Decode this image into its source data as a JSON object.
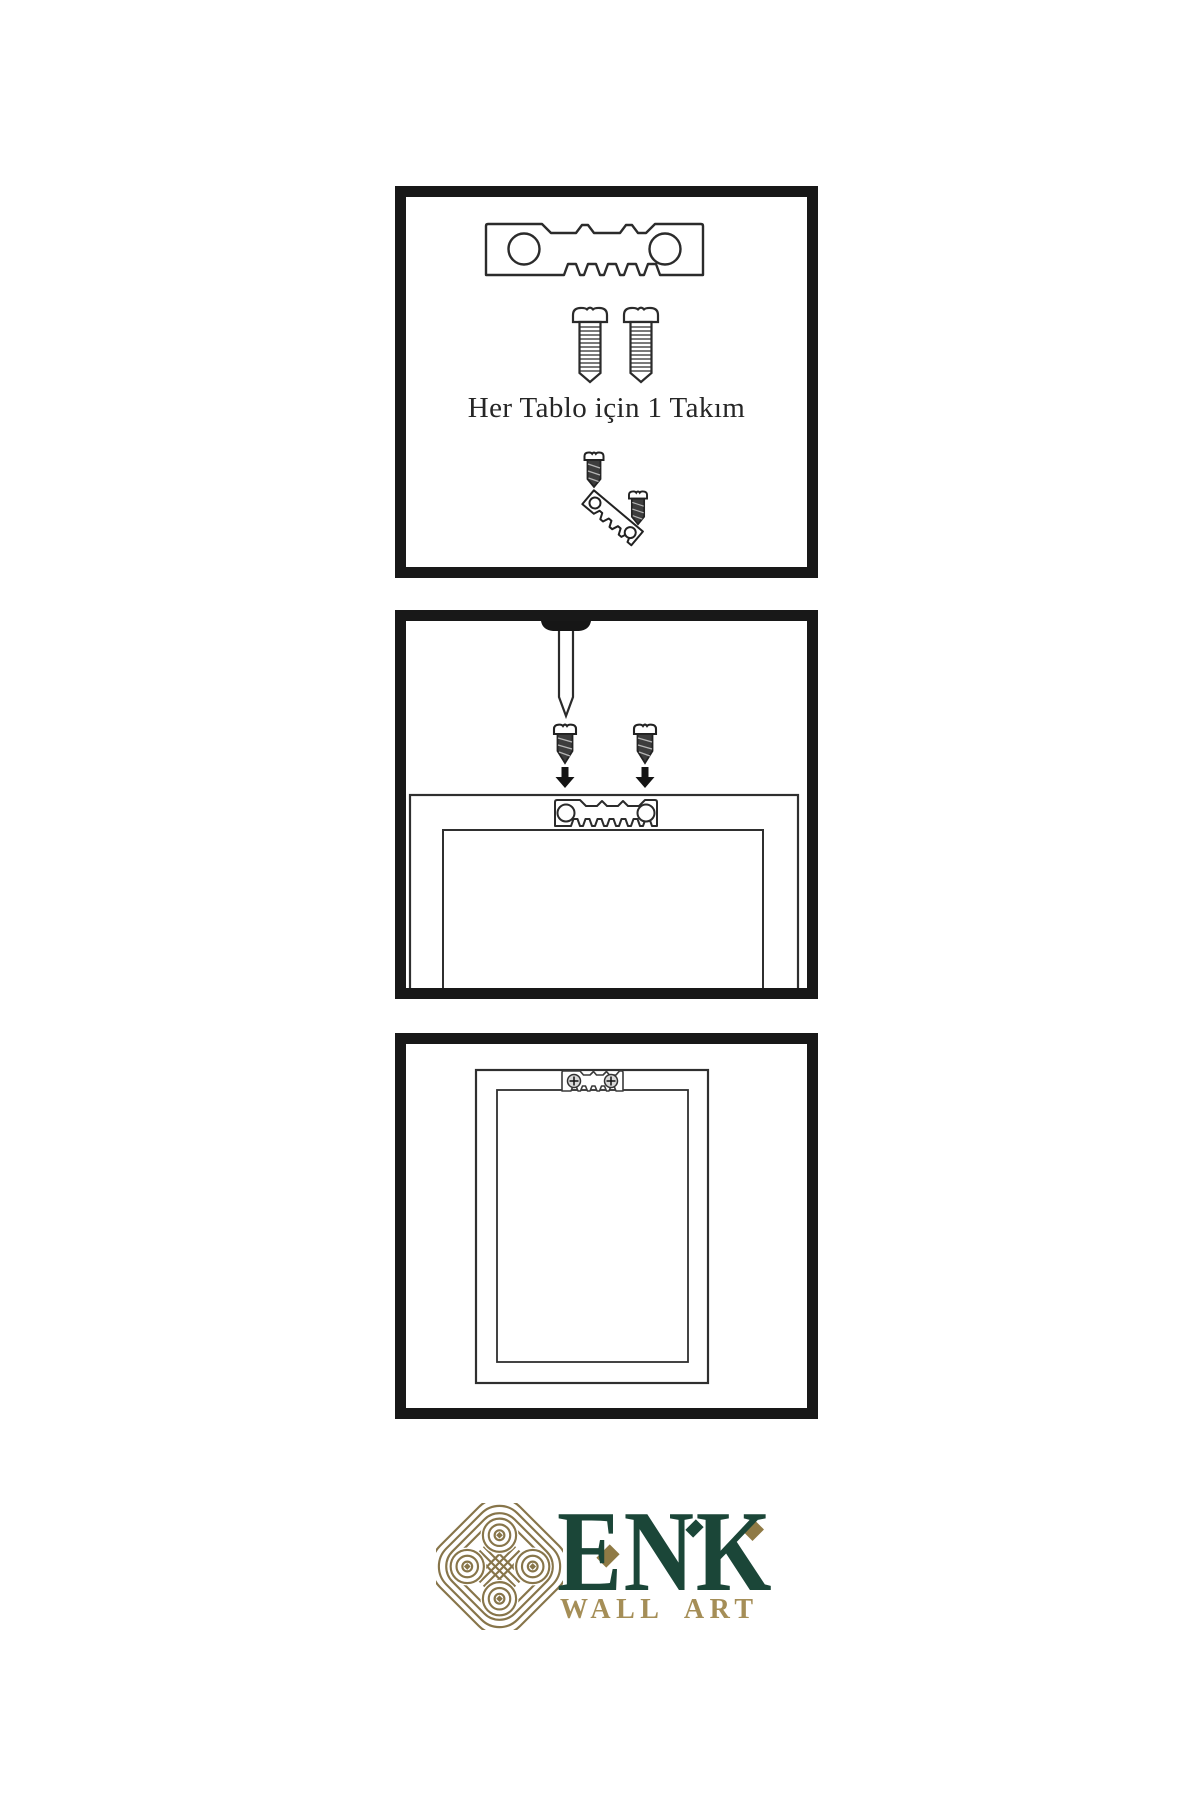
{
  "sheet": {
    "type": "wall-art hanging hardware instruction sheet",
    "background": "#ffffff"
  },
  "colors": {
    "ink": "#2b2b2b",
    "panel_border": "#181818",
    "brand_green": "#1b4638",
    "brand_gold": "#8f7a45",
    "brand_gold_light": "#a58e57"
  },
  "panels": [
    {
      "name": "hardware-kit",
      "caption": "Her Tablo için 1 Takım",
      "icons": [
        "sawtooth-hanger-icon",
        "screw-icon",
        "screw-icon",
        "tilted-hanger-with-screws-icon"
      ]
    },
    {
      "name": "wall-mounting",
      "caption": "",
      "icons": [
        "nail-icon",
        "screw-icon",
        "arrow-down-icon",
        "screw-icon",
        "arrow-down-icon",
        "frame-back-icon",
        "sawtooth-hanger-icon"
      ]
    },
    {
      "name": "hanging-result",
      "caption": "",
      "icons": [
        "frame-back-icon",
        "installed-sawtooth-hanger-icon"
      ]
    }
  ],
  "brand": {
    "name": "ENK",
    "tagline": "WALL ART",
    "logo": "knot-logo-icon"
  }
}
